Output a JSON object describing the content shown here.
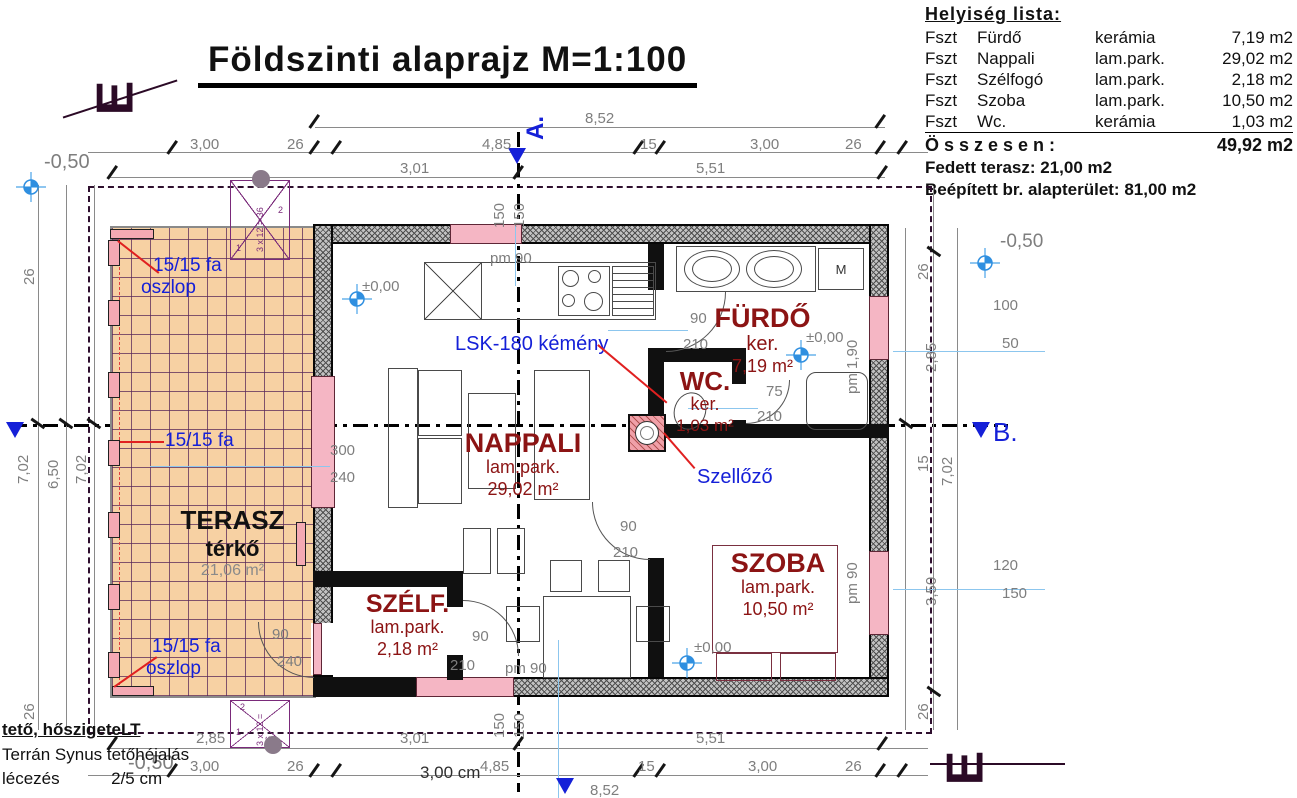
{
  "title": "Földszinti alaprajz  M=1:100",
  "room_list": {
    "header": "Helyiség  lista:",
    "rows": [
      {
        "floor": "Fszt",
        "name": "Fürdő",
        "finish": "kerámia",
        "area": "7,19 m2"
      },
      {
        "floor": "Fszt",
        "name": "Nappali",
        "finish": "lam.park.",
        "area": "29,02 m2"
      },
      {
        "floor": "Fszt",
        "name": "Szélfogó",
        "finish": "lam.park.",
        "area": "2,18 m2"
      },
      {
        "floor": "Fszt",
        "name": "Szoba",
        "finish": "lam.park.",
        "area": "10,50 m2"
      },
      {
        "floor": "Fszt",
        "name": "Wc.",
        "finish": "kerámia",
        "area": "1,03 m2"
      }
    ],
    "total_label": "Ö s s z e s e n :",
    "total_value": "49,92 m2",
    "covered_terrace": "Fedett terasz: 21,00 m2",
    "gross_area": "Beépített br. alapterület: 81,00 m2"
  },
  "rooms": {
    "nappali": {
      "name": "NAPPALI",
      "finish": "lam.park.",
      "area": "29,02 m²"
    },
    "furdo": {
      "name": "FÜRDŐ",
      "finish": "ker.",
      "area": "7,19 m²"
    },
    "wc": {
      "name": "WC.",
      "finish": "ker.",
      "area": "1,03 m²"
    },
    "szoba": {
      "name": "SZOBA",
      "finish": "lam.park.",
      "area": "10,50 m²"
    },
    "szelfogo": {
      "name": "SZÉLF.",
      "finish": "lam.park.",
      "area": "2,18 m²"
    },
    "terasz": {
      "name": "TERASZ",
      "finish": "térkő",
      "area": "21,06 m²"
    }
  },
  "annotations": {
    "post_top": "15/15 fa",
    "post_top2": "oszlop",
    "post_mid": "15/15 fa",
    "post_bot": "15/15 fa",
    "post_bot2": "oszlop",
    "chimney": "LSK-180 kémény",
    "vent": "Szellőző",
    "washer": "M"
  },
  "levels": {
    "minus050": "-0,50",
    "zero": "±0,00"
  },
  "sections": {
    "a": "A.",
    "b": "B."
  },
  "notes": {
    "roof_title": "tető, hőszigeteLT",
    "roof_line1": "Terrán Synus tetőhéjalás",
    "roof_line2": "lécezés",
    "roof_line2b": "2/5 cm",
    "cm_note": "3,00 cm"
  },
  "stairs": {
    "formula": "3 x 12 = 36",
    "n1": "1",
    "n2": "2"
  },
  "dims": {
    "overall": "8,52",
    "top_row": [
      "3,00",
      "26",
      "4,85",
      "15",
      "3,00",
      "26"
    ],
    "top_row2": [
      "3,01",
      "5,51"
    ],
    "axis150": "150",
    "bottom_row2": [
      "2,85",
      "3,01",
      "5,51"
    ],
    "bottom_row": [
      "3,00",
      "26",
      "4,85",
      "15",
      "3,00",
      "26"
    ],
    "left_col": [
      "26",
      "7,02",
      "6,50",
      "7,02",
      "26"
    ],
    "right_col": [
      "26",
      "2,85",
      "15",
      "7,02",
      "3,50",
      "26"
    ],
    "win_furdo": [
      "100",
      "50"
    ],
    "pm_furdo": "pm 1,90",
    "win_szoba": [
      "120",
      "150"
    ],
    "pm_szoba": "pm 90",
    "win_nappali": [
      "300",
      "240"
    ],
    "door_terasz": [
      "90",
      "240"
    ],
    "door_furdo": [
      "90",
      "210"
    ],
    "door_wc": [
      "75",
      "210"
    ],
    "door_szoba": [
      "90",
      "210"
    ],
    "door_szelfogo": [
      "90",
      "210"
    ],
    "pm_kitchen": "pm 90",
    "pm_entry": "pm 90"
  }
}
